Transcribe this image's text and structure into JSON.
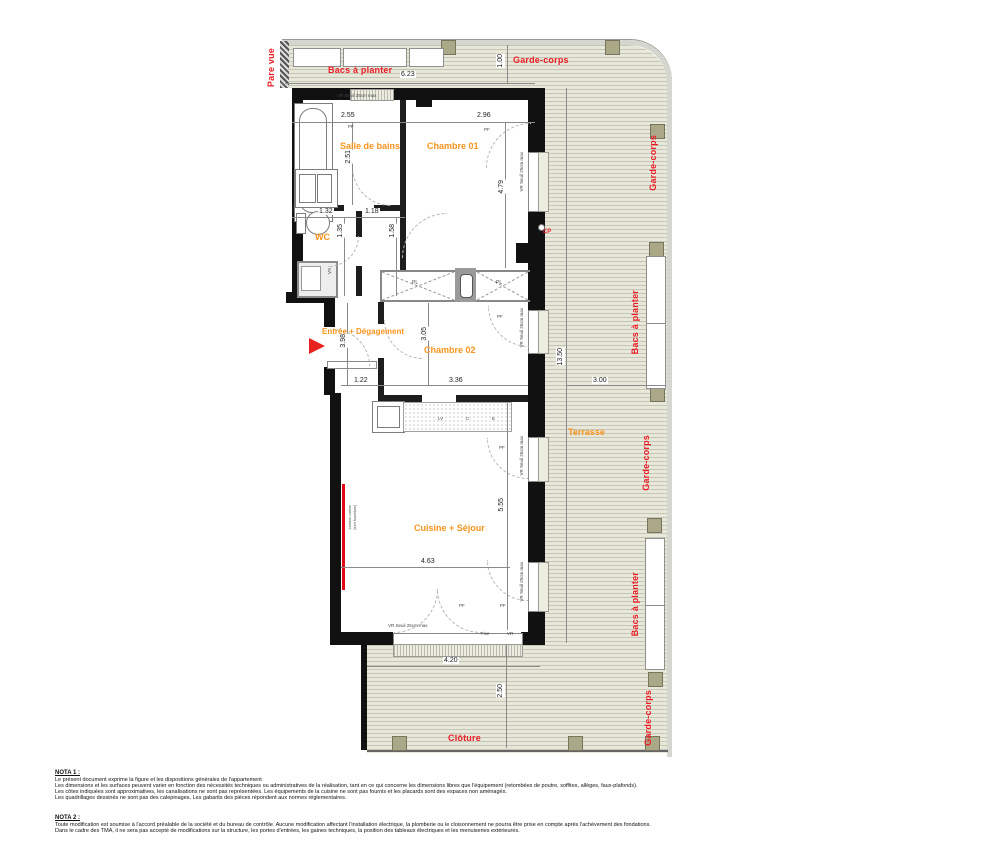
{
  "rooms": {
    "salle_de_bains": "Salle de bains",
    "chambre_01": "Chambre 01",
    "wc": "WC",
    "entree": "Entrée + Dégagement",
    "chambre_02": "Chambre 02",
    "cuisine_sejour": "Cuisine + Séjour"
  },
  "outdoor": {
    "pare_vue": "Pare vue",
    "bacs_a_planter_top": "Bacs à planter",
    "garde_corps_top": "Garde-corps",
    "garde_corps_right_1": "Garde-corps",
    "bacs_a_planter_right_1": "Bacs à planter",
    "garde_corps_right_2": "Garde-corps",
    "bacs_a_planter_right_2": "Bacs à planter",
    "garde_corps_right_3": "Garde-corps",
    "terrasse": "Terrasse",
    "cloture": "Clôture",
    "ep": "EP"
  },
  "dims": {
    "planter_width": "6.23",
    "walkway": "1.00",
    "sdb_w": "2.55",
    "ch01_w": "2.96",
    "sdb_h": "2.51",
    "ch01_h": "4.79",
    "wc_w": "1.32",
    "hall_w": "1.18",
    "wc_h": "1.35",
    "hall_h": "1.58",
    "entree_h": "3.98",
    "ch02_h": "3.05",
    "entree_w": "1.22",
    "ch02_w": "3.36",
    "terrasse_h": "13.50",
    "terrasse_w": "3.00",
    "cuisine_h": "5.55",
    "cuisine_w": "4.63",
    "terrasse_sud_w": "4.20",
    "terrasse_sud_h": "2.50"
  },
  "annotations": {
    "seuil": "VR  Seuil 25cm max",
    "fixe": "Fixe",
    "vr": "VR",
    "pf": "PF",
    "pl": "PL",
    "lv": "LV",
    "c": "C",
    "e": "E",
    "vs": "VS",
    "red_line_1": "Linéaire cuisine",
    "red_line_2": "(hors fourniture)"
  },
  "notes": {
    "nota1": {
      "title": "NOTA 1 :",
      "lines": [
        "Le présent document exprime la figure et les dispositions générales de l'appartement",
        "Les dimensions et les surfaces peuvent varier en fonction des nécessités techniques ou administratives de la réalisation, tant en ce qui concerne les dimensions libres que l'équipement (retombées de poutre, soffites, allèges, faux-plafonds).",
        "Les côtes indiquées sont approximatives, les canalisations ne sont pas représentées. Les équipements de la cuisine ne sont pas fournis et les placards sont des espaces non aménagés.",
        "Les quadrillages dessinés ne sont pas des calepinages. Les gabarits des pièces répondent aux normes réglementaires."
      ]
    },
    "nota2": {
      "title": "NOTA 2 :",
      "lines": [
        "Toute modification est soumise à l'accord préalable de la société et du bureau de contrôle. Aucune modification affectant l'installation électrique, la plomberie ou le cloisonnement ne pourra être prise en compte après l'achèvement des fondations.",
        "Dans le cadre des TMA, il ne sera pas accepté de modifications sur la structure, les portes d'entrées, les gaines techniques, la position des tableaux électriques et les menuiseries extérieures."
      ]
    }
  }
}
